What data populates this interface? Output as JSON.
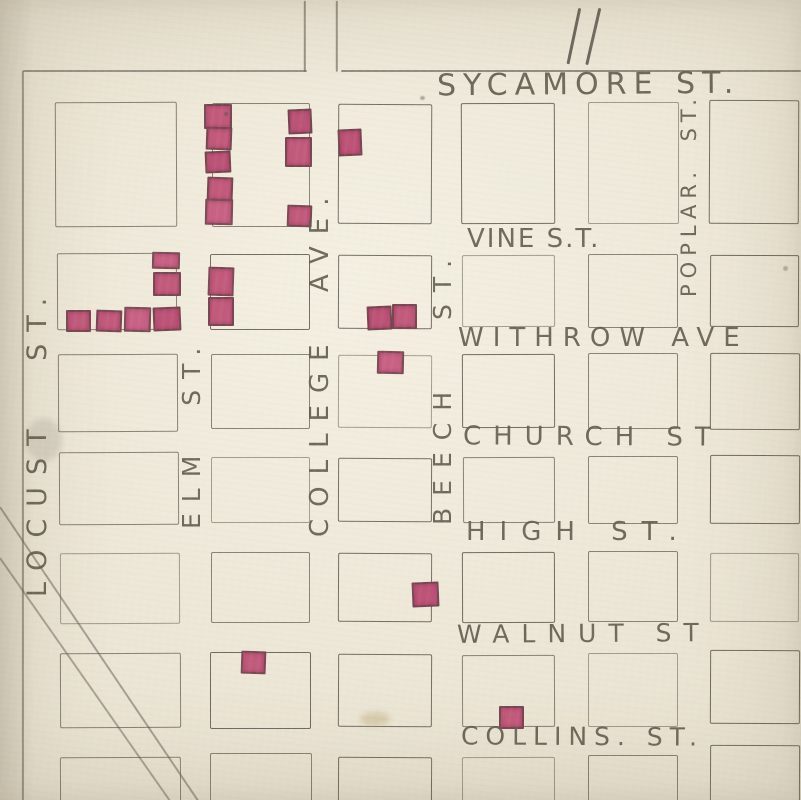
{
  "map": {
    "kind": "hand-drawn plat map page",
    "page_number": "11",
    "colors": {
      "paper": "#e8e2d1",
      "pencil": "#5f5a4e",
      "building_marker": "#c25a7c"
    },
    "streets": {
      "horizontal": [
        {
          "label": "SYCAMORE ST.",
          "x": 437,
          "y": 70,
          "font": 30,
          "ls": 7,
          "rot": -0.5
        },
        {
          "label": "VINE S.T.",
          "x": 467,
          "y": 226,
          "font": 26,
          "ls": 2,
          "rot": 0
        },
        {
          "label": "WITHROW AVE",
          "x": 458,
          "y": 325,
          "font": 26,
          "ls": 9,
          "rot": 0
        },
        {
          "label": "CHURCH ST",
          "x": 463,
          "y": 424,
          "font": 26,
          "ls": 12,
          "rot": 0.3
        },
        {
          "label": "HIGH ST.",
          "x": 466,
          "y": 519,
          "font": 26,
          "ls": 14,
          "rot": 0
        },
        {
          "label": "WALNUT ST",
          "x": 457,
          "y": 621,
          "font": 25,
          "ls": 12,
          "rot": -0.4
        },
        {
          "label": "COLLINS. ST.",
          "x": 461,
          "y": 724,
          "font": 25,
          "ls": 7,
          "rot": 0.3
        }
      ],
      "vertical": [
        {
          "label": "LOCUST ST.",
          "x": 24,
          "y": 597,
          "font": 27,
          "ls": 12,
          "ws": 36
        },
        {
          "label": "ELM ST.",
          "x": 179,
          "y": 529,
          "font": 25,
          "ls": 11,
          "ws": 20
        },
        {
          "label": "COLLEGE AVE.",
          "x": 307,
          "y": 537,
          "font": 26,
          "ls": 12,
          "ws": 20
        },
        {
          "label": "BEECH ST.",
          "x": 430,
          "y": 525,
          "font": 25,
          "ls": 12,
          "ws": 40
        },
        {
          "label": "POPLAR. ST.",
          "x": 679,
          "y": 297,
          "font": 21,
          "ls": 6,
          "ws": 12
        }
      ]
    },
    "blocks": [
      [
        55,
        102,
        120,
        123
      ],
      [
        212,
        103,
        96,
        122
      ],
      [
        338,
        104,
        92,
        118
      ],
      [
        461,
        103,
        92,
        119
      ],
      [
        588,
        102,
        89,
        120
      ],
      [
        709,
        100,
        88,
        122
      ],
      [
        57,
        253,
        118,
        75
      ],
      [
        210,
        254,
        98,
        74
      ],
      [
        338,
        255,
        92,
        72
      ],
      [
        462,
        255,
        91,
        70
      ],
      [
        588,
        254,
        88,
        72
      ],
      [
        710,
        255,
        87,
        70
      ],
      [
        58,
        354,
        118,
        76
      ],
      [
        211,
        354,
        97,
        73
      ],
      [
        338,
        355,
        92,
        71
      ],
      [
        462,
        354,
        91,
        72
      ],
      [
        588,
        353,
        88,
        74
      ],
      [
        710,
        353,
        88,
        75
      ],
      [
        59,
        452,
        118,
        71
      ],
      [
        211,
        457,
        97,
        64
      ],
      [
        338,
        458,
        92,
        62
      ],
      [
        463,
        457,
        90,
        64
      ],
      [
        588,
        456,
        88,
        66
      ],
      [
        710,
        455,
        88,
        67
      ],
      [
        60,
        553,
        118,
        69
      ],
      [
        211,
        552,
        97,
        69
      ],
      [
        338,
        553,
        92,
        67
      ],
      [
        462,
        552,
        91,
        69
      ],
      [
        588,
        551,
        88,
        69
      ],
      [
        710,
        553,
        87,
        67
      ],
      [
        60,
        653,
        119,
        73
      ],
      [
        210,
        652,
        99,
        75
      ],
      [
        338,
        654,
        92,
        71
      ],
      [
        462,
        655,
        91,
        70
      ],
      [
        588,
        653,
        88,
        72
      ],
      [
        710,
        650,
        88,
        72
      ],
      [
        60,
        757,
        119,
        55
      ],
      [
        210,
        753,
        100,
        57
      ],
      [
        338,
        757,
        92,
        55
      ],
      [
        462,
        757,
        91,
        55
      ],
      [
        588,
        755,
        88,
        55
      ],
      [
        710,
        745,
        88,
        65
      ]
    ],
    "buildings": [
      [
        204,
        104,
        24,
        21
      ],
      [
        206,
        127,
        22,
        19
      ],
      [
        205,
        151,
        22,
        18
      ],
      [
        207,
        177,
        22,
        20
      ],
      [
        205,
        199,
        24,
        22
      ],
      [
        288,
        109,
        20,
        21
      ],
      [
        285,
        137,
        23,
        26
      ],
      [
        287,
        205,
        21,
        18
      ],
      [
        338,
        129,
        20,
        23
      ],
      [
        152,
        252,
        24,
        13
      ],
      [
        153,
        272,
        24,
        20
      ],
      [
        153,
        307,
        24,
        20
      ],
      [
        66,
        310,
        21,
        18
      ],
      [
        96,
        310,
        22,
        18
      ],
      [
        124,
        307,
        23,
        21
      ],
      [
        208,
        267,
        22,
        25
      ],
      [
        208,
        297,
        22,
        25
      ],
      [
        367,
        306,
        21,
        20
      ],
      [
        392,
        304,
        21,
        21
      ],
      [
        377,
        351,
        23,
        19
      ],
      [
        412,
        582,
        23,
        21
      ],
      [
        241,
        651,
        21,
        19
      ],
      [
        499,
        706,
        21,
        19
      ]
    ],
    "lines": [
      {
        "name": "sycamore-north-line-west",
        "x": 23,
        "y": 70,
        "len": 284,
        "angle": 0,
        "t": 2.0,
        "o": 0.72
      },
      {
        "name": "sycamore-north-line-east",
        "x": 341,
        "y": 70,
        "len": 460,
        "angle": 0,
        "t": 2.0,
        "o": 0.78
      },
      {
        "name": "map-left-border-line",
        "x": 23,
        "y": 70,
        "len": 732,
        "angle": 90,
        "t": 1.8,
        "o": 0.68
      },
      {
        "name": "college-ave-extension-west",
        "x": 305,
        "y": 0,
        "len": 71,
        "angle": 90,
        "t": 1.6,
        "o": 0.72
      },
      {
        "name": "college-ave-extension-east",
        "x": 337,
        "y": 0,
        "len": 71,
        "angle": 90,
        "t": 1.6,
        "o": 0.72
      },
      {
        "name": "railroad-line-1",
        "x": 0,
        "y": 506,
        "len": 358,
        "angle": 56,
        "t": 1.7,
        "o": 0.62
      },
      {
        "name": "railroad-line-2",
        "x": 0,
        "y": 557,
        "len": 300,
        "angle": 55,
        "t": 1.7,
        "o": 0.58
      },
      {
        "name": "page-number-stroke-1",
        "x": 580,
        "y": 7,
        "len": 57,
        "angle": 102,
        "t": 2.6,
        "o": 0.8
      },
      {
        "name": "page-number-stroke-2",
        "x": 600,
        "y": 7,
        "len": 58,
        "angle": 103,
        "t": 2.6,
        "o": 0.8
      }
    ],
    "smudges": [
      {
        "x": 26,
        "y": 418,
        "w": 36,
        "h": 44,
        "c": "#8a8578",
        "o": 0.22
      },
      {
        "x": 360,
        "y": 712,
        "w": 30,
        "h": 14,
        "c": "#c0ad7e",
        "o": 0.45
      },
      {
        "x": 224,
        "y": 112,
        "w": 4,
        "h": 4,
        "c": "#55504a",
        "o": 0.5
      },
      {
        "x": 783,
        "y": 266,
        "w": 5,
        "h": 5,
        "c": "#6a645a",
        "o": 0.4
      },
      {
        "x": 420,
        "y": 96,
        "w": 5,
        "h": 4,
        "c": "#5f5a50",
        "o": 0.45
      }
    ]
  }
}
